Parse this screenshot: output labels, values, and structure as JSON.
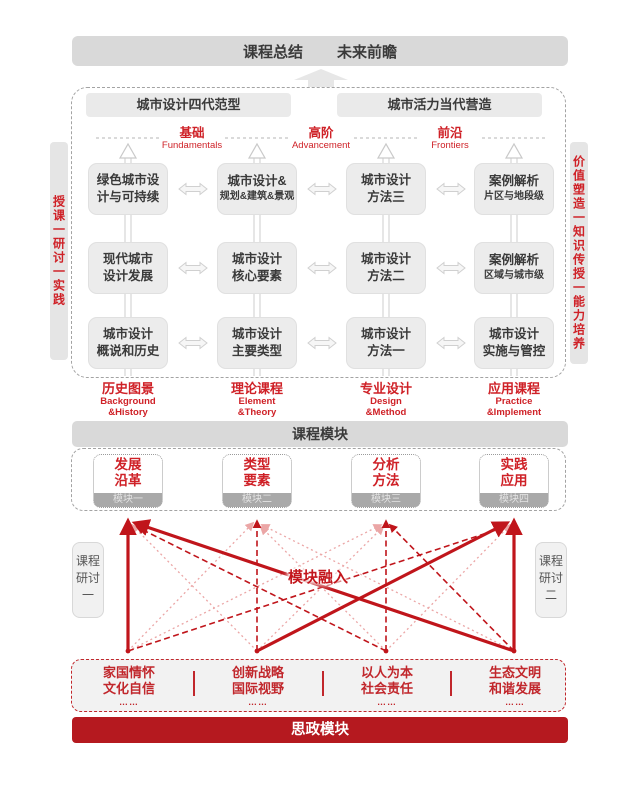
{
  "colors": {
    "accent_red": "#cf2127",
    "deep_red": "#b5191f",
    "line_red": "#c0151b",
    "line_pink": "#eba6a6",
    "box_gray": "#d9d9d9"
  },
  "summary_bar": {
    "left": "课程总结",
    "right": "未来前瞻"
  },
  "paradigms": [
    {
      "label": "城市设计四代范型"
    },
    {
      "label": "城市活力当代营造"
    }
  ],
  "tiers": [
    {
      "zh": "基础",
      "en": "Fundamentals"
    },
    {
      "zh": "高阶",
      "en": "Advancement"
    },
    {
      "zh": "前沿",
      "en": "Frontiers"
    }
  ],
  "sidebar_left": "授课一研讨一实践",
  "sidebar_right": "价值塑造一知识传授一能力培养",
  "grid": {
    "rows": [
      {
        "cells": [
          {
            "line1": "绿色城市设",
            "line2": "计与可持续"
          },
          {
            "line1": "城市设计&",
            "line2": "规划&建筑&景观"
          },
          {
            "line1": "城市设计",
            "line2": "方法三"
          },
          {
            "line1": "案例解析",
            "line2": "片区与地段级"
          }
        ]
      },
      {
        "cells": [
          {
            "line1": "现代城市",
            "line2": "设计发展"
          },
          {
            "line1": "城市设计",
            "line2": "核心要素"
          },
          {
            "line1": "城市设计",
            "line2": "方法二"
          },
          {
            "line1": "案例解析",
            "line2": "区域与城市级"
          }
        ]
      },
      {
        "cells": [
          {
            "line1": "城市设计",
            "line2": "概说和历史"
          },
          {
            "line1": "城市设计",
            "line2": "主要类型"
          },
          {
            "line1": "城市设计",
            "line2": "方法一"
          },
          {
            "line1": "城市设计",
            "line2": "实施与管控"
          }
        ]
      }
    ]
  },
  "column_footers": [
    {
      "zh": "历史图景",
      "en1": "Background",
      "en2": "&History"
    },
    {
      "zh": "理论课程",
      "en1": "Element",
      "en2": "&Theory"
    },
    {
      "zh": "专业设计",
      "en1": "Design",
      "en2": "&Method"
    },
    {
      "zh": "应用课程",
      "en1": "Practice",
      "en2": "&Implement"
    }
  ],
  "course_module_bar": "课程模块",
  "modules": [
    {
      "line1": "发展",
      "line2": "沿革",
      "tag": "模块一"
    },
    {
      "line1": "类型",
      "line2": "要素",
      "tag": "模块二"
    },
    {
      "line1": "分析",
      "line2": "方法",
      "tag": "模块三"
    },
    {
      "line1": "实践",
      "line2": "应用",
      "tag": "模块四"
    }
  ],
  "seminar_left": {
    "l1": "课程",
    "l2": "研讨",
    "l3": "一"
  },
  "seminar_right": {
    "l1": "课程",
    "l2": "研讨",
    "l3": "二"
  },
  "fusion_label": "模块融入",
  "ideology": {
    "items": [
      {
        "line1": "家国情怀",
        "line2": "文化自信",
        "dots": "……"
      },
      {
        "line1": "创新战略",
        "line2": "国际视野",
        "dots": "……"
      },
      {
        "line1": "以人为本",
        "line2": "社会责任",
        "dots": "……"
      },
      {
        "line1": "生态文明",
        "line2": "和谐发展",
        "dots": "……"
      }
    ],
    "bar": "思政模块"
  }
}
